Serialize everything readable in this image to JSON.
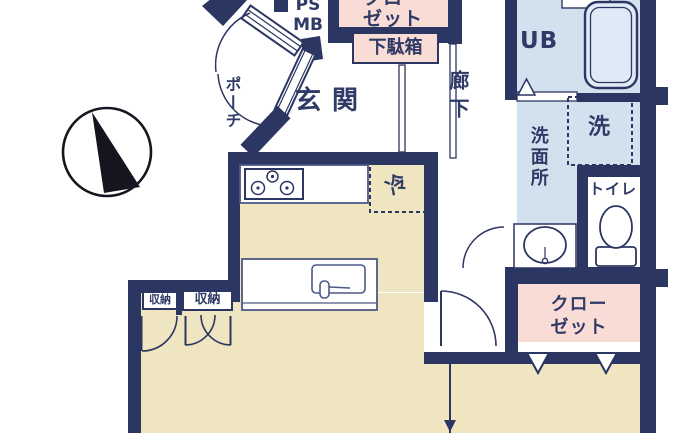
{
  "colors": {
    "wall_navy": "#2c3663",
    "floor_tan": "#f0e5c1",
    "closet_pink": "#f9dcd6",
    "bath_blue": "#d3e1ef",
    "label_navy": "#2f3a66"
  },
  "rooms": {
    "entrance": "玄関",
    "porch": "ポーチ",
    "hallway": "廊下",
    "unit_bath": "UB",
    "washroom": "洗面所",
    "toilet": "トイレ",
    "closet_top": [
      "クロー",
      "ゼット"
    ],
    "closet_main": [
      "クロー",
      "ゼット"
    ]
  },
  "fixtures": {
    "pipe_space": "PS",
    "meter_box": "MB",
    "shoe_cabinet": "下駄箱",
    "storage_left": "収納",
    "storage_right": "収納",
    "refrigerator": "冷",
    "washing_machine": "洗"
  }
}
